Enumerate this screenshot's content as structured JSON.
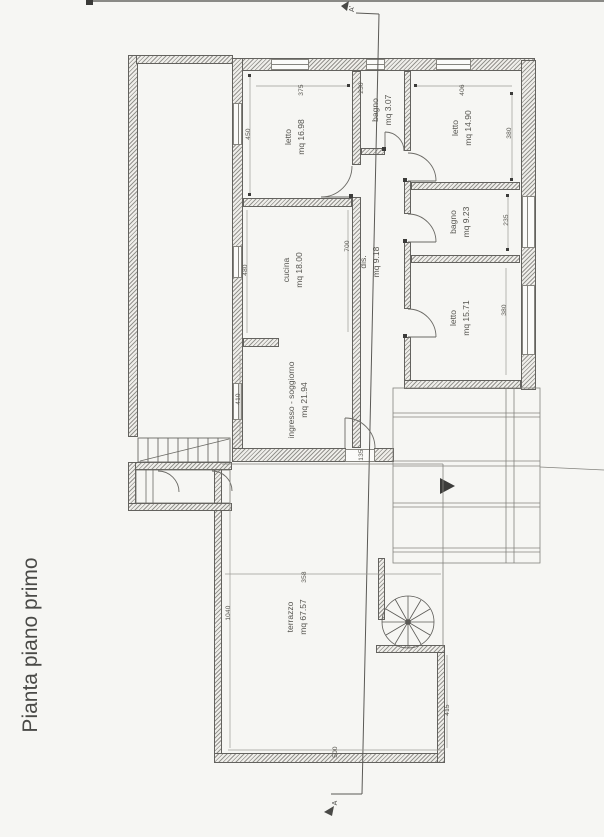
{
  "document": {
    "title": "Pianta piano primo"
  },
  "section": {
    "top_label": "A'",
    "bottom_label": "A"
  },
  "rooms": [
    {
      "name": "letto",
      "area": "mq 16.98"
    },
    {
      "name": "bagno",
      "area": "mq 3.07"
    },
    {
      "name": "letto",
      "area": "mq 14.90"
    },
    {
      "name": "cucina",
      "area": "mq 18.00"
    },
    {
      "name": "dis.",
      "area": "mq 9.18"
    },
    {
      "name": "bagno",
      "area": "mq 9.23"
    },
    {
      "name": "letto",
      "area": "mq 15.71"
    },
    {
      "name": "ingresso - soggiorno",
      "area": "mq 21.94"
    },
    {
      "name": "terrazzo",
      "area": "mq 67.57"
    }
  ],
  "dimensions": [
    "375",
    "450",
    "230",
    "406",
    "380",
    "235",
    "380",
    "480",
    "700",
    "410",
    "135",
    "1040",
    "358",
    "500",
    "415"
  ],
  "colors": {
    "paper": "#f6f6f3",
    "ink": "#4a4a47",
    "wall_hatch": "#95948f",
    "dim_text": "#56554f"
  }
}
